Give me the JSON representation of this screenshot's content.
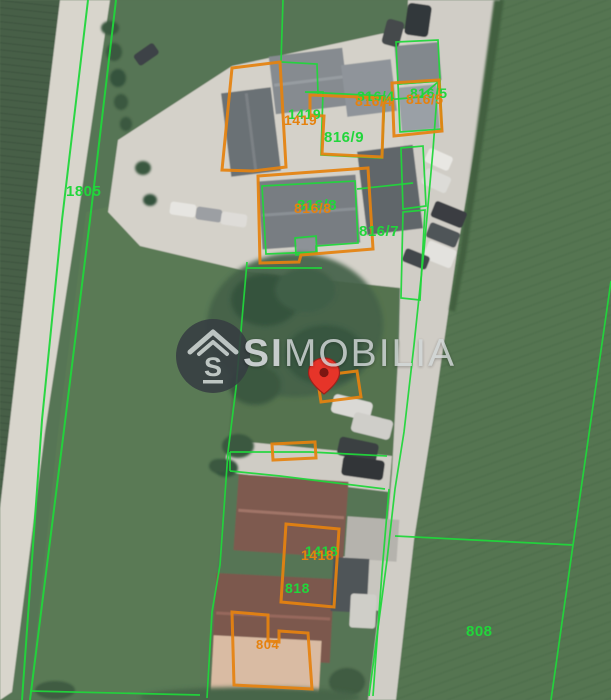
{
  "map": {
    "watermark": {
      "brand_bold": "SI",
      "brand_rest": "MOBILIA",
      "logo_letter": "S"
    },
    "parcels": {
      "green_labels": {
        "p1805": "1805",
        "p816_4": "816/4",
        "p816_5": "816/5",
        "p1419": "1419",
        "p816_9": "816/9",
        "p816_8": "816/8",
        "p816_7": "816/7",
        "p1418": "1418",
        "p818": "818",
        "p808": "808"
      },
      "orange_labels": {
        "p816_4": "816/4",
        "p816_5": "816/5",
        "p1419": "1419",
        "p816_8": "816/8",
        "p1418": "1418",
        "p804": "804"
      }
    },
    "colors": {
      "cadastral_green": "#21d63b",
      "highlight_orange": "#e5820f",
      "pin_red": "#e63429",
      "watermark_gray": "#d2d6d8"
    }
  }
}
